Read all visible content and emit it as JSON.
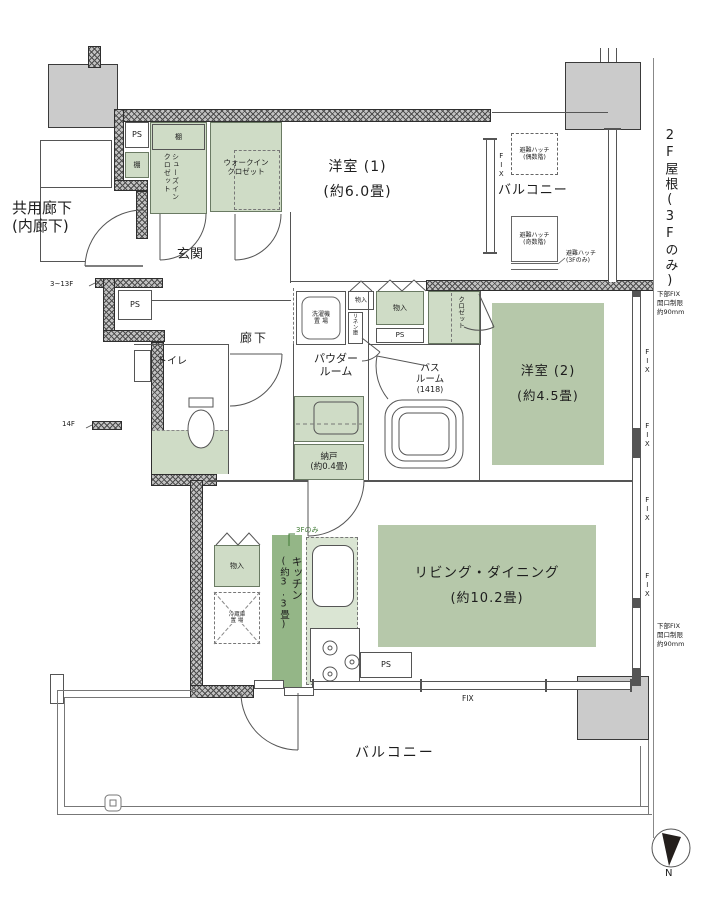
{
  "colors": {
    "room_green": "#b6c8aa",
    "storage_green": "#cfdcc6",
    "kitchen_green": "#94b687",
    "counter_green": "#dae5d3",
    "wall_gray": "#c2c2c2",
    "block_gray": "#cbcbcb",
    "accent_green_text": "#3f7a34",
    "line": "#555555"
  },
  "rooms": {
    "common_corridor": {
      "line1": "共用廊下",
      "line2": "(内廊下)"
    },
    "entrance": "玄関",
    "hallway": "廊下",
    "western1": {
      "name": "洋室 (1)",
      "size": "(約6.0畳)"
    },
    "western2": {
      "name": "洋室 (2)",
      "size": "(約4.5畳)"
    },
    "living": {
      "name": "リビング・ダイニング",
      "size": "(約10.2畳)"
    },
    "kitchen": {
      "name": "キッチン",
      "size": "(約3.3畳)"
    },
    "powder": {
      "line1": "パウダー",
      "line2": "ルーム"
    },
    "toilet": "トイレ",
    "bath": {
      "line1": "バス",
      "line2": "ルーム",
      "size": "(1418)"
    },
    "storeroom": {
      "name": "納戸",
      "size": "(約0.4畳)"
    },
    "balcony_upper": "バルコニー",
    "balcony_lower": "バルコニー"
  },
  "storage": {
    "shoes_closet": {
      "line1": "シューズイン",
      "line2": "クロゼット"
    },
    "walk_in": {
      "line1": "ウォークイン",
      "line2": "クロゼット"
    },
    "closet": "クロゼット",
    "shelf": "棚",
    "storage_small": "物入",
    "linen": "リネン庫",
    "washer": {
      "line1": "洗濯機",
      "line2": "置 場"
    },
    "fridge": {
      "line1": "冷蔵庫",
      "line2": "置 場"
    },
    "pipe_space": "PS"
  },
  "annotations": {
    "roof": "2F屋根(3Fのみ)",
    "hatch_even": {
      "line1": "避難ハッチ",
      "line2": "(偶数階)"
    },
    "hatch_odd": {
      "line1": "避難ハッチ",
      "line2": "(奇数階)"
    },
    "hatch_3f": {
      "line1": "避難ハッチ",
      "line2": "(3Fのみ)"
    },
    "fix": "FIX",
    "fix_note": {
      "line1": "下部FIX",
      "line2": "開口制限",
      "line3": "約90mm"
    },
    "floors_3_13": "3~13F",
    "floor_14": "14F",
    "only_3f": "3Fのみ",
    "north": "N"
  }
}
